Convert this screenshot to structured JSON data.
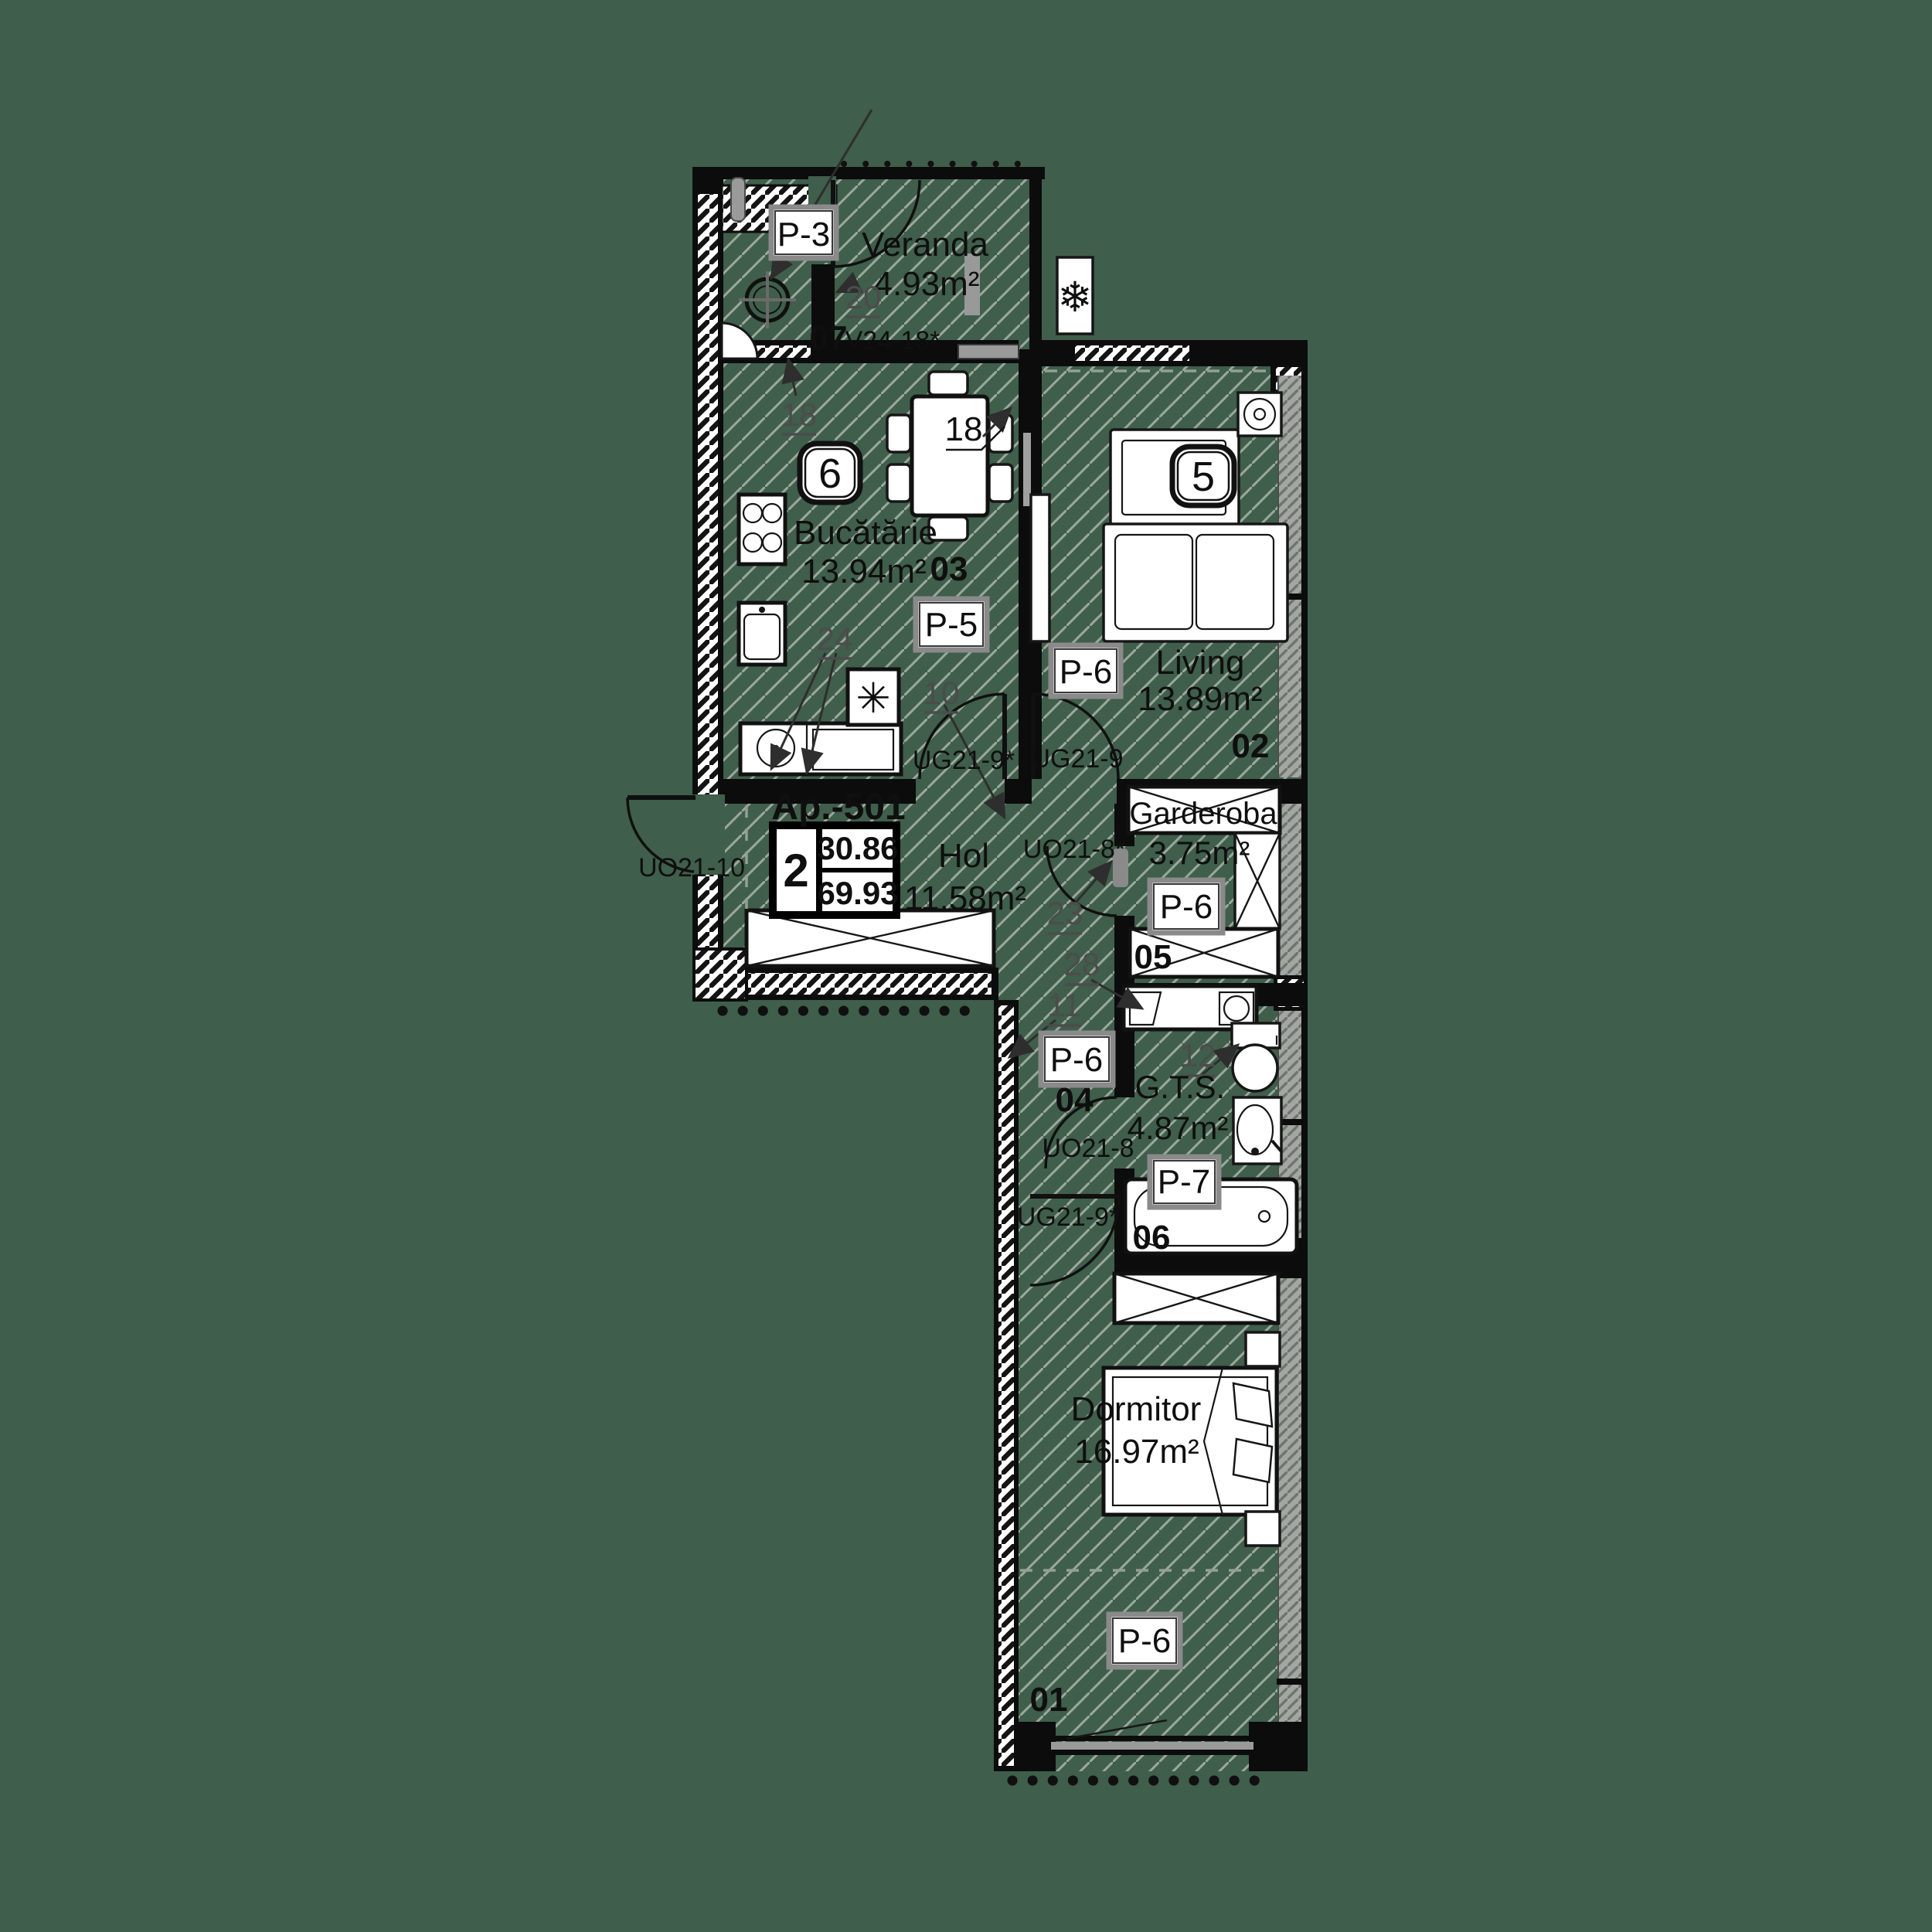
{
  "background_color": "#3f5e4b",
  "plan": {
    "apartment": {
      "label": "Ap.-501",
      "rooms_count": "2",
      "area_useful": "30.86",
      "area_total": "69.93"
    },
    "rooms": {
      "dormitor": {
        "number": "01",
        "name": "Dormitor",
        "area": "16.97m²",
        "finish": "P-6"
      },
      "living": {
        "number": "02",
        "name": "Living",
        "area": "13.89m²",
        "finish": "P-6"
      },
      "bucatarie": {
        "number": "03",
        "name": "Bucătărie",
        "area": "13.94m²",
        "finish": "P-5"
      },
      "hol": {
        "number": "04",
        "name": "Hol",
        "area": "11.58m²",
        "finish": "P-6"
      },
      "garderoba": {
        "number": "05",
        "name": "Garderoba",
        "area": "3.75m²",
        "finish": "P-6"
      },
      "gts": {
        "number": "06",
        "name": "G.T.S.",
        "area": "4.87m²",
        "finish": "P-7"
      },
      "veranda": {
        "number": "07",
        "name": "Veranda",
        "area": "4.93m²",
        "finish": "P-3",
        "window_code": "V24-18*"
      }
    },
    "doors": {
      "entry": "UO21-10",
      "kitchen": "UG21-9*",
      "living": "UG21-9",
      "garderoba": "UO21-8*",
      "gts": "UO21-8",
      "dormitor": "UG21-9*"
    },
    "badges": {
      "kitchen": "6",
      "living": "5"
    },
    "markers": {
      "veranda": "20",
      "kitchen_wall": "18",
      "kitchen_table": "18",
      "kitchen_counter": "24",
      "kitchen_door": "10",
      "hol_door": "23",
      "hol_wall": "28",
      "corridor": "11",
      "bath": "12"
    },
    "icons": {
      "fridge": "✳",
      "ac": "❄"
    }
  }
}
